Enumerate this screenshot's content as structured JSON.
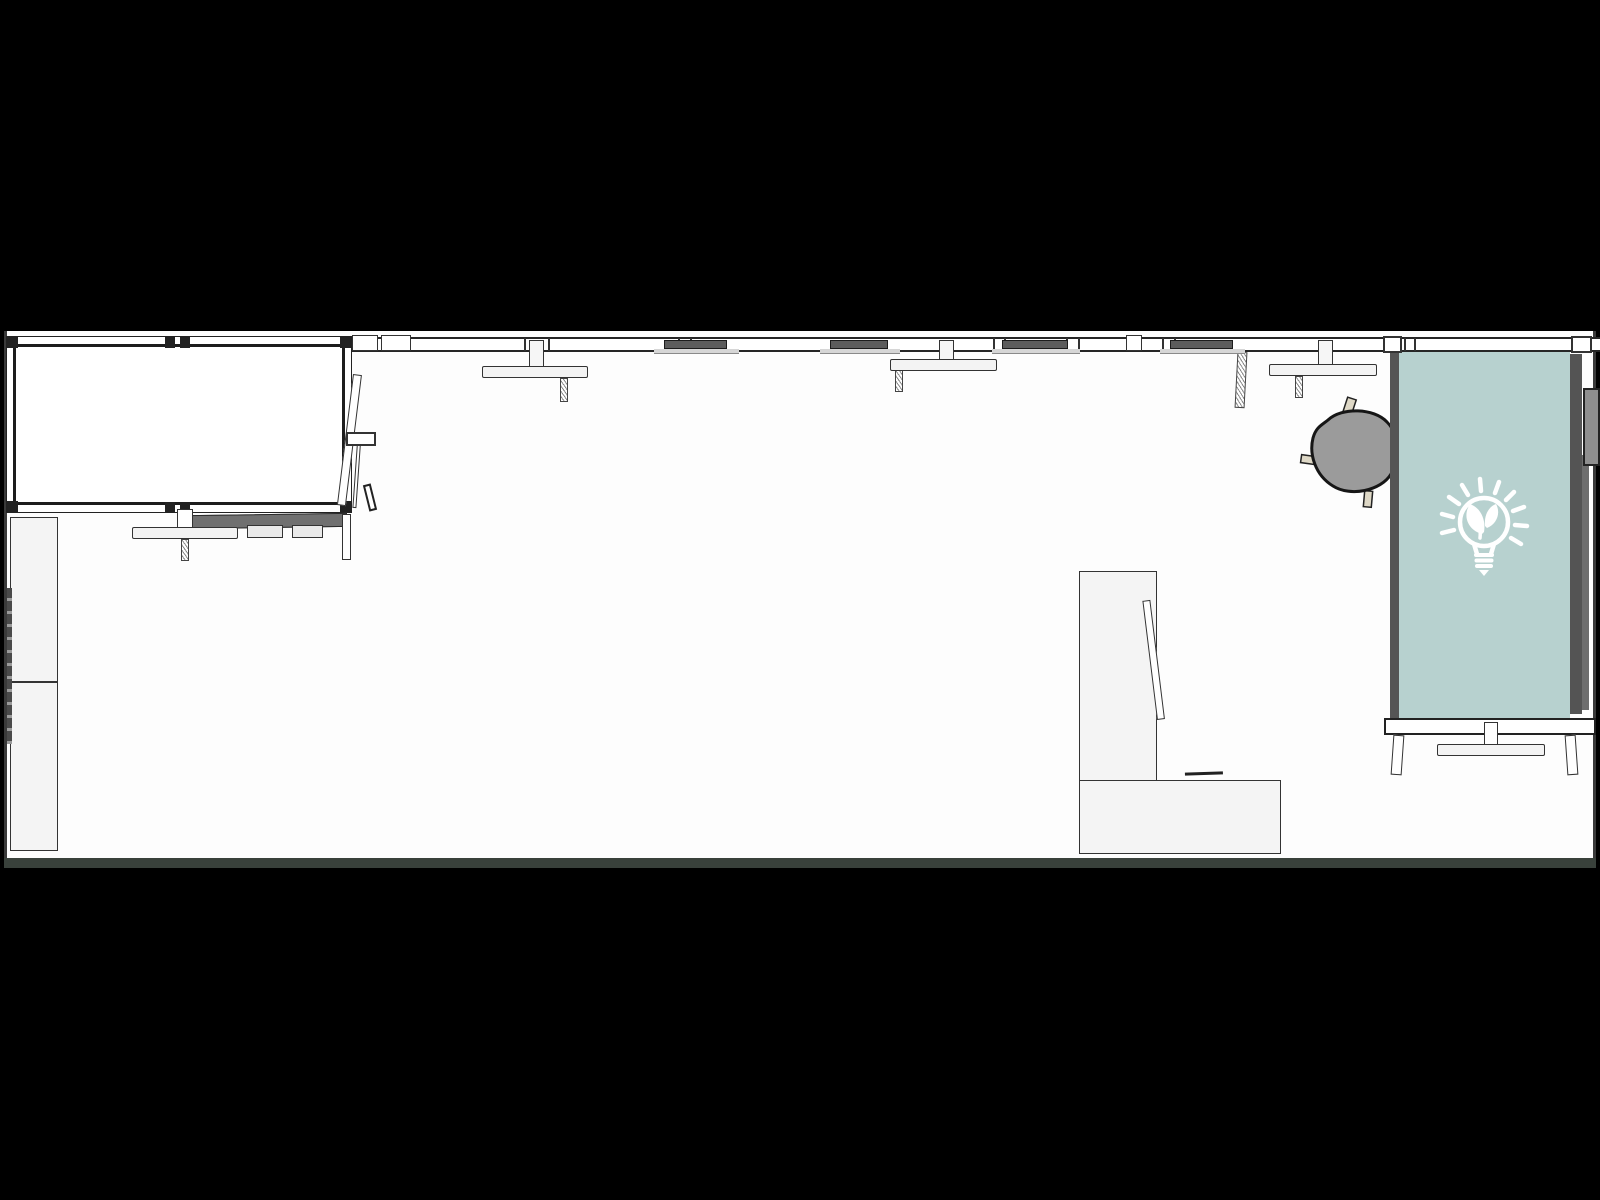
{
  "scene": {
    "view": "top-down-floor-plan",
    "room_count": 1,
    "background_color": "#000000",
    "floor_color": "#fdfdfd",
    "wall_line_color": "#2a2a2a"
  },
  "palette": {
    "accent_teal_panel": "#b7d1cf",
    "chair_gray": "#9b9b9b",
    "display_bar_gray": "#5c5c5c",
    "furniture_fill": "#f4f4f4",
    "leg_beige": "#ded8c6",
    "panel_frame_dark": "#545454",
    "dark_desk_surface": "#707070",
    "wall_cabinet_gray": "#8f8f8f",
    "icon_white": "#ffffff"
  },
  "panel": {
    "icon": "eco-lightbulb-icon",
    "icon_description": "light bulb with plant sprout and rays",
    "color": "#b7d1cf"
  },
  "furniture": {
    "wall_ticks": [
      356,
      366,
      392,
      402,
      524,
      548,
      678,
      690,
      993,
      1004,
      1066,
      1078,
      1162,
      1174,
      1404,
      1414
    ],
    "wall_blocks": [
      {
        "x": 352,
        "w": 26
      },
      {
        "x": 381,
        "w": 30
      },
      {
        "x": 1126,
        "w": 16
      }
    ],
    "wall_displays": [
      {
        "x": 664,
        "w": 63
      },
      {
        "x": 830,
        "w": 58
      },
      {
        "x": 1002,
        "w": 66
      },
      {
        "x": 1170,
        "w": 63
      }
    ],
    "wall_desks": [
      {
        "x": 482,
        "w": 106,
        "bar_y": 366,
        "connector_dx": 47,
        "leg_dx": 78,
        "leg_top": 378,
        "leg_h": 24
      },
      {
        "x": 890,
        "w": 107,
        "bar_y": 359,
        "connector_dx": 49,
        "leg_dx": 5,
        "leg_top": 360,
        "leg_h": 32
      },
      {
        "x": 1269,
        "w": 108,
        "bar_y": 364,
        "connector_dx": 49,
        "leg_dx": 26,
        "leg_top": 376,
        "leg_h": 22
      }
    ]
  }
}
